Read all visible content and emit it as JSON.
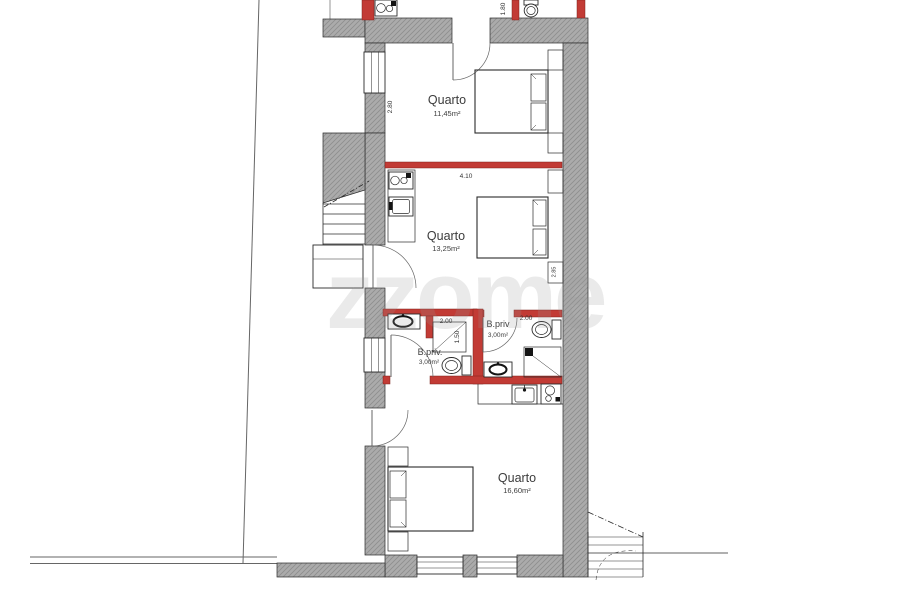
{
  "watermark": {
    "text": "zzome"
  },
  "plan": {
    "rooms": {
      "quarto1": {
        "name": "Quarto",
        "area": "11,45m²"
      },
      "quarto2": {
        "name": "Quarto",
        "area": "13,25m²"
      },
      "quarto3": {
        "name": "Quarto",
        "area": "16,60m²"
      },
      "bath_left": {
        "name": "B.priv.",
        "area": "3,00m²"
      },
      "bath_right": {
        "name": "B.priv",
        "area": "3,00m²"
      }
    },
    "dimensions": {
      "quarto2_width": "4.10",
      "quarto1_depth": "2.80",
      "bath_left_width": "2.00",
      "bath_left_shower": "1.50",
      "bath_right_width": "2.00",
      "top_room_depth": "1.80",
      "quarto2_depth": "2.85"
    },
    "colors": {
      "wall_gray": "#ababab",
      "wall_hatch": "#8e8e8e",
      "highlight_red": "#c23b35",
      "line": "#2b2b2b",
      "watermark_gray": "#9a9a9a"
    }
  }
}
